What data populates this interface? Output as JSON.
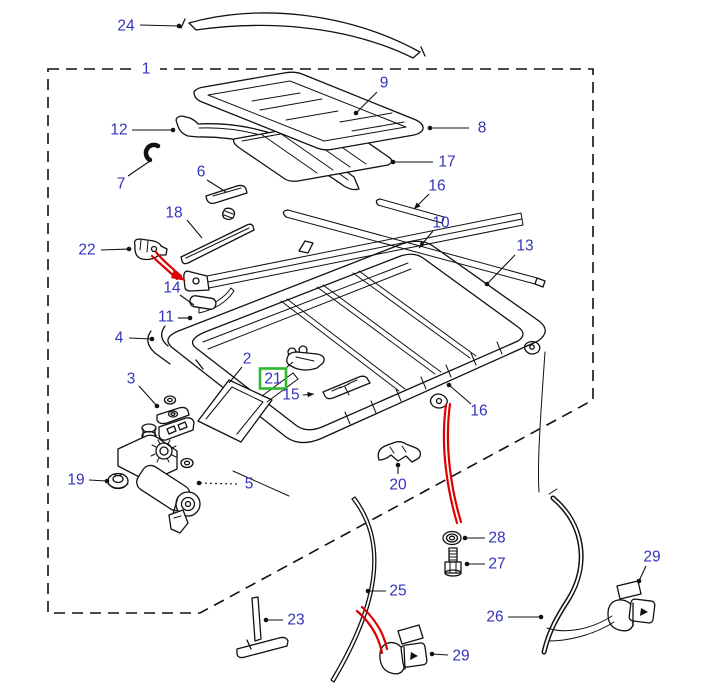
{
  "figure": {
    "kind": "exploded-parts-diagram",
    "canvas": {
      "width": 717,
      "height": 686
    },
    "colors": {
      "background": "#ffffff",
      "line": "#111111",
      "label": "#3333bb",
      "highlight_box": "#2db82d",
      "cable_red": "#dd0000"
    },
    "highlighted_label": "21"
  },
  "labels": [
    {
      "t": "24",
      "x": 126,
      "y": 26,
      "l": [
        140,
        25,
        179,
        26
      ],
      "end": "dot"
    },
    {
      "t": "1",
      "x": 146,
      "y": 69,
      "l": null,
      "end": "none",
      "bg": true
    },
    {
      "t": "12",
      "x": 119,
      "y": 130,
      "l": [
        132,
        130,
        173,
        130
      ],
      "end": "dot"
    },
    {
      "t": "7",
      "x": 121,
      "y": 184,
      "l": [
        128,
        176,
        150,
        161
      ],
      "end": "none"
    },
    {
      "t": "6",
      "x": 201,
      "y": 172,
      "l": [
        207,
        180,
        226,
        192
      ],
      "end": "none"
    },
    {
      "t": "18",
      "x": 174,
      "y": 213,
      "l": [
        187,
        220,
        202,
        238
      ],
      "end": "none"
    },
    {
      "t": "22",
      "x": 87,
      "y": 250,
      "l": [
        101,
        250,
        129,
        249
      ],
      "end": "dot"
    },
    {
      "t": "14",
      "x": 172,
      "y": 288,
      "l": [
        180,
        295,
        194,
        305
      ],
      "end": "none"
    },
    {
      "t": "11",
      "x": 166,
      "y": 317,
      "l": [
        178,
        318,
        190,
        318
      ],
      "end": "dot"
    },
    {
      "t": "4",
      "x": 119,
      "y": 338,
      "l": [
        129,
        338,
        152,
        339
      ],
      "end": "dot"
    },
    {
      "t": "9",
      "x": 384,
      "y": 83,
      "l": [
        377,
        92,
        356,
        113
      ],
      "end": "dot"
    },
    {
      "t": "8",
      "x": 482,
      "y": 128,
      "l": [
        469,
        128,
        430,
        128
      ],
      "end": "dot"
    },
    {
      "t": "17",
      "x": 447,
      "y": 162,
      "l": [
        433,
        162,
        393,
        162
      ],
      "end": "dot"
    },
    {
      "t": "16",
      "x": 437,
      "y": 186,
      "l": [
        429,
        194,
        414,
        209
      ],
      "end": "arrow"
    },
    {
      "t": "10",
      "x": 441,
      "y": 223,
      "l": [
        433,
        231,
        419,
        248
      ],
      "end": "arrow"
    },
    {
      "t": "13",
      "x": 525,
      "y": 246,
      "l": [
        515,
        255,
        487,
        284
      ],
      "end": "dot"
    },
    {
      "t": "2",
      "x": 247,
      "y": 359,
      "l": [
        242,
        367,
        229,
        383
      ],
      "end": "none"
    },
    {
      "t": "21",
      "x": 273,
      "y": 379,
      "l": [
        286,
        368,
        293,
        362
      ],
      "end": "none",
      "green": true
    },
    {
      "t": "15",
      "x": 291,
      "y": 395,
      "l": [
        303,
        395,
        314,
        394
      ],
      "end": "arrow"
    },
    {
      "t": "3",
      "x": 131,
      "y": 379,
      "l": [
        139,
        386,
        157,
        406
      ],
      "end": "dot"
    },
    {
      "t": "19",
      "x": 76,
      "y": 480,
      "l": [
        89,
        480,
        107,
        481
      ],
      "end": "dot"
    },
    {
      "t": "5",
      "x": 249,
      "y": 484,
      "l": [
        237,
        484,
        199,
        483
      ],
      "end": "dot",
      "dashed": true
    },
    {
      "t": "23",
      "x": 296,
      "y": 620,
      "l": [
        283,
        620,
        266,
        620
      ],
      "end": "dot"
    },
    {
      "t": "20",
      "x": 398,
      "y": 485,
      "l": [
        398,
        474,
        398,
        465
      ],
      "end": "dot"
    },
    {
      "t": "16",
      "x": 479,
      "y": 411,
      "l": [
        471,
        404,
        449,
        385
      ],
      "end": "dot"
    },
    {
      "t": "28",
      "x": 497,
      "y": 538,
      "l": [
        485,
        538,
        465,
        538
      ],
      "end": "dot"
    },
    {
      "t": "27",
      "x": 497,
      "y": 564,
      "l": [
        485,
        564,
        467,
        564
      ],
      "end": "dot"
    },
    {
      "t": "25",
      "x": 398,
      "y": 591,
      "l": [
        386,
        591,
        368,
        591
      ],
      "end": "dot"
    },
    {
      "t": "26",
      "x": 495,
      "y": 617,
      "l": [
        508,
        617,
        541,
        617
      ],
      "end": "dot"
    },
    {
      "t": "29",
      "x": 652,
      "y": 557,
      "l": [
        646,
        566,
        639,
        581
      ],
      "end": "dot"
    },
    {
      "t": "29",
      "x": 461,
      "y": 656,
      "l": [
        448,
        655,
        432,
        654
      ],
      "end": "dot"
    }
  ]
}
